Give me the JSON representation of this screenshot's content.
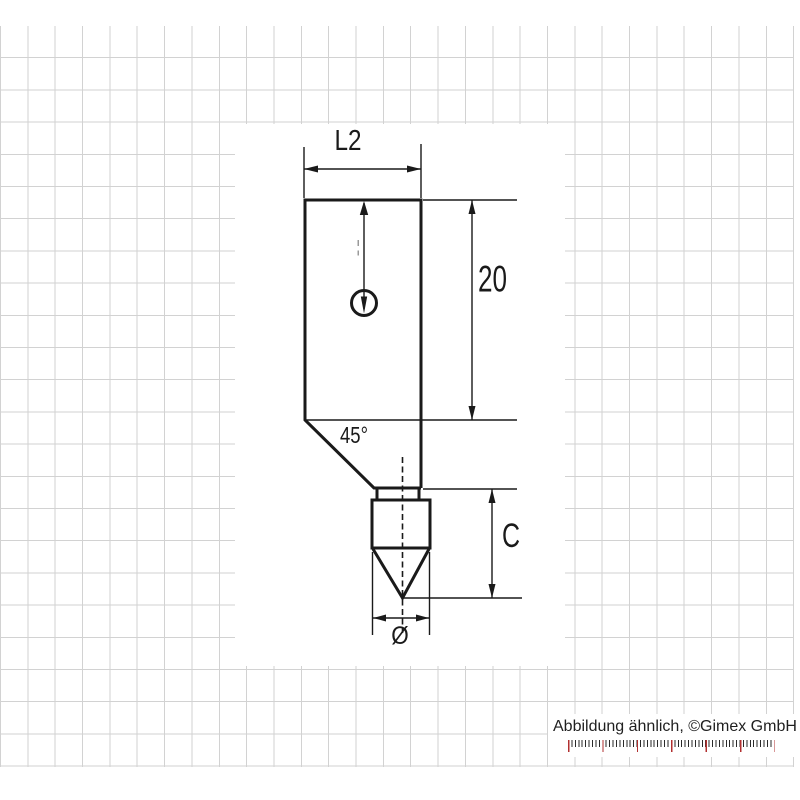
{
  "colors": {
    "grid_line": "#d2d2d2",
    "drawing_stroke": "#1a1a1a",
    "caption_text": "#1f1f1f",
    "ruler_tick": "#2a2a2a",
    "ruler_tick_accent": "#b23030"
  },
  "drawing": {
    "labels": {
      "top_width": "L2",
      "body_height": "20",
      "chamfer_angle": "45°",
      "tip_height": "C",
      "tip_diameter": "Ø"
    }
  },
  "footer": {
    "caption": "Abbildung ähnlich, ©Gimex GmbH"
  }
}
